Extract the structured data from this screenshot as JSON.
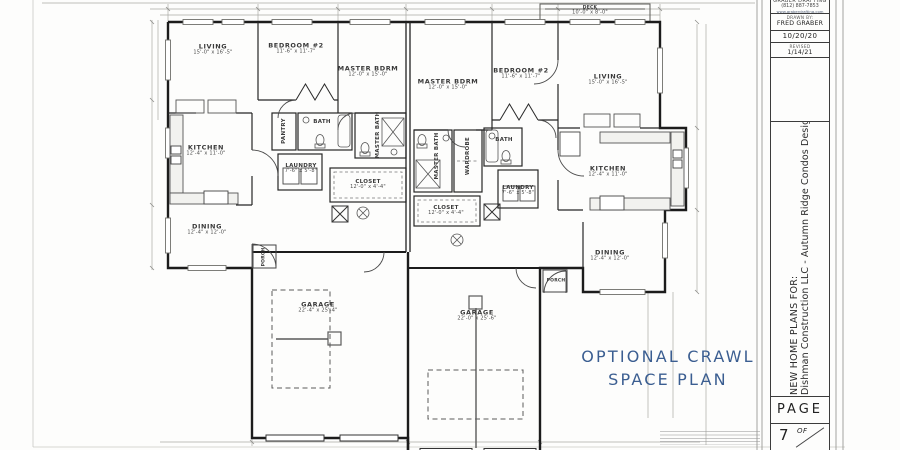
{
  "title_block": {
    "company": "GRABER DRAFTING",
    "phone": "(812) 887-7853",
    "website": "www.graberdrafting.com",
    "drawn_by_label": "DRAWN BY:",
    "drawn_by": "FRED GRABER",
    "date": "10/20/20",
    "revised_label": "REVISED",
    "revised_date": "1/14/21",
    "project_line1": "NEW HOME PLANS FOR:",
    "project_line2": "Dishman Construction LLC - Autumn Ridge Condos Design 2",
    "page_label": "PAGE",
    "page_number": "7",
    "of_label": "OF"
  },
  "annotation": {
    "line1": "OPTIONAL CRAWL",
    "line2": "SPACE PLAN",
    "color": "#3b5e91"
  },
  "plan": {
    "deck": {
      "name": "DECK",
      "dims": "10'-0\" x 8'-0\""
    },
    "left": {
      "living": {
        "name": "LIVING",
        "dims": "15'-0\" x 16'-5\""
      },
      "bedroom2": {
        "name": "BEDROOM #2",
        "dims": "11'-6\" x 11'-7\""
      },
      "master": {
        "name": "MASTER BDRM",
        "dims": "12'-0\" x 15'-0\""
      },
      "kitchen": {
        "name": "KITCHEN",
        "dims": "12'-4\" x 11'-0\""
      },
      "dining": {
        "name": "DINING",
        "dims": "12'-4\" x 12'-0\""
      },
      "bath": {
        "name": "BATH"
      },
      "pantry": {
        "name": "PANTRY"
      },
      "laundry": {
        "name": "LAUNDRY",
        "dims": "7'-6\" x 5'-8\""
      },
      "master_bath": {
        "name": "MASTER BATH"
      },
      "closet": {
        "name": "CLOSET",
        "dims": "12'-0\" x 4'-4\""
      },
      "garage": {
        "name": "GARAGE",
        "dims": "22'-4\" x 25'-4\""
      },
      "porch": {
        "name": "PORCH"
      }
    },
    "right": {
      "master": {
        "name": "MASTER BDRM",
        "dims": "12'-0\" x 15'-0\""
      },
      "bedroom2": {
        "name": "BEDROOM #2",
        "dims": "11'-6\" x 11'-7\""
      },
      "living": {
        "name": "LIVING",
        "dims": "15'-0\" x 16'-5\""
      },
      "master_bath": {
        "name": "MASTER BATH"
      },
      "wardrobe": {
        "name": "WARDROBE"
      },
      "bath": {
        "name": "BATH"
      },
      "laundry": {
        "name": "LAUNDRY",
        "dims": "7'-6\" x 5'-8\""
      },
      "closet": {
        "name": "CLOSET",
        "dims": "12'-0\" x 4'-4\""
      },
      "kitchen": {
        "name": "KITCHEN",
        "dims": "12'-4\" x 11'-0\""
      },
      "dining": {
        "name": "DINING",
        "dims": "12'-4\" x 12'-0\""
      },
      "garage": {
        "name": "GARAGE",
        "dims": "22'-0\" x 25'-6\""
      },
      "porch": {
        "name": "PORCH"
      }
    }
  }
}
